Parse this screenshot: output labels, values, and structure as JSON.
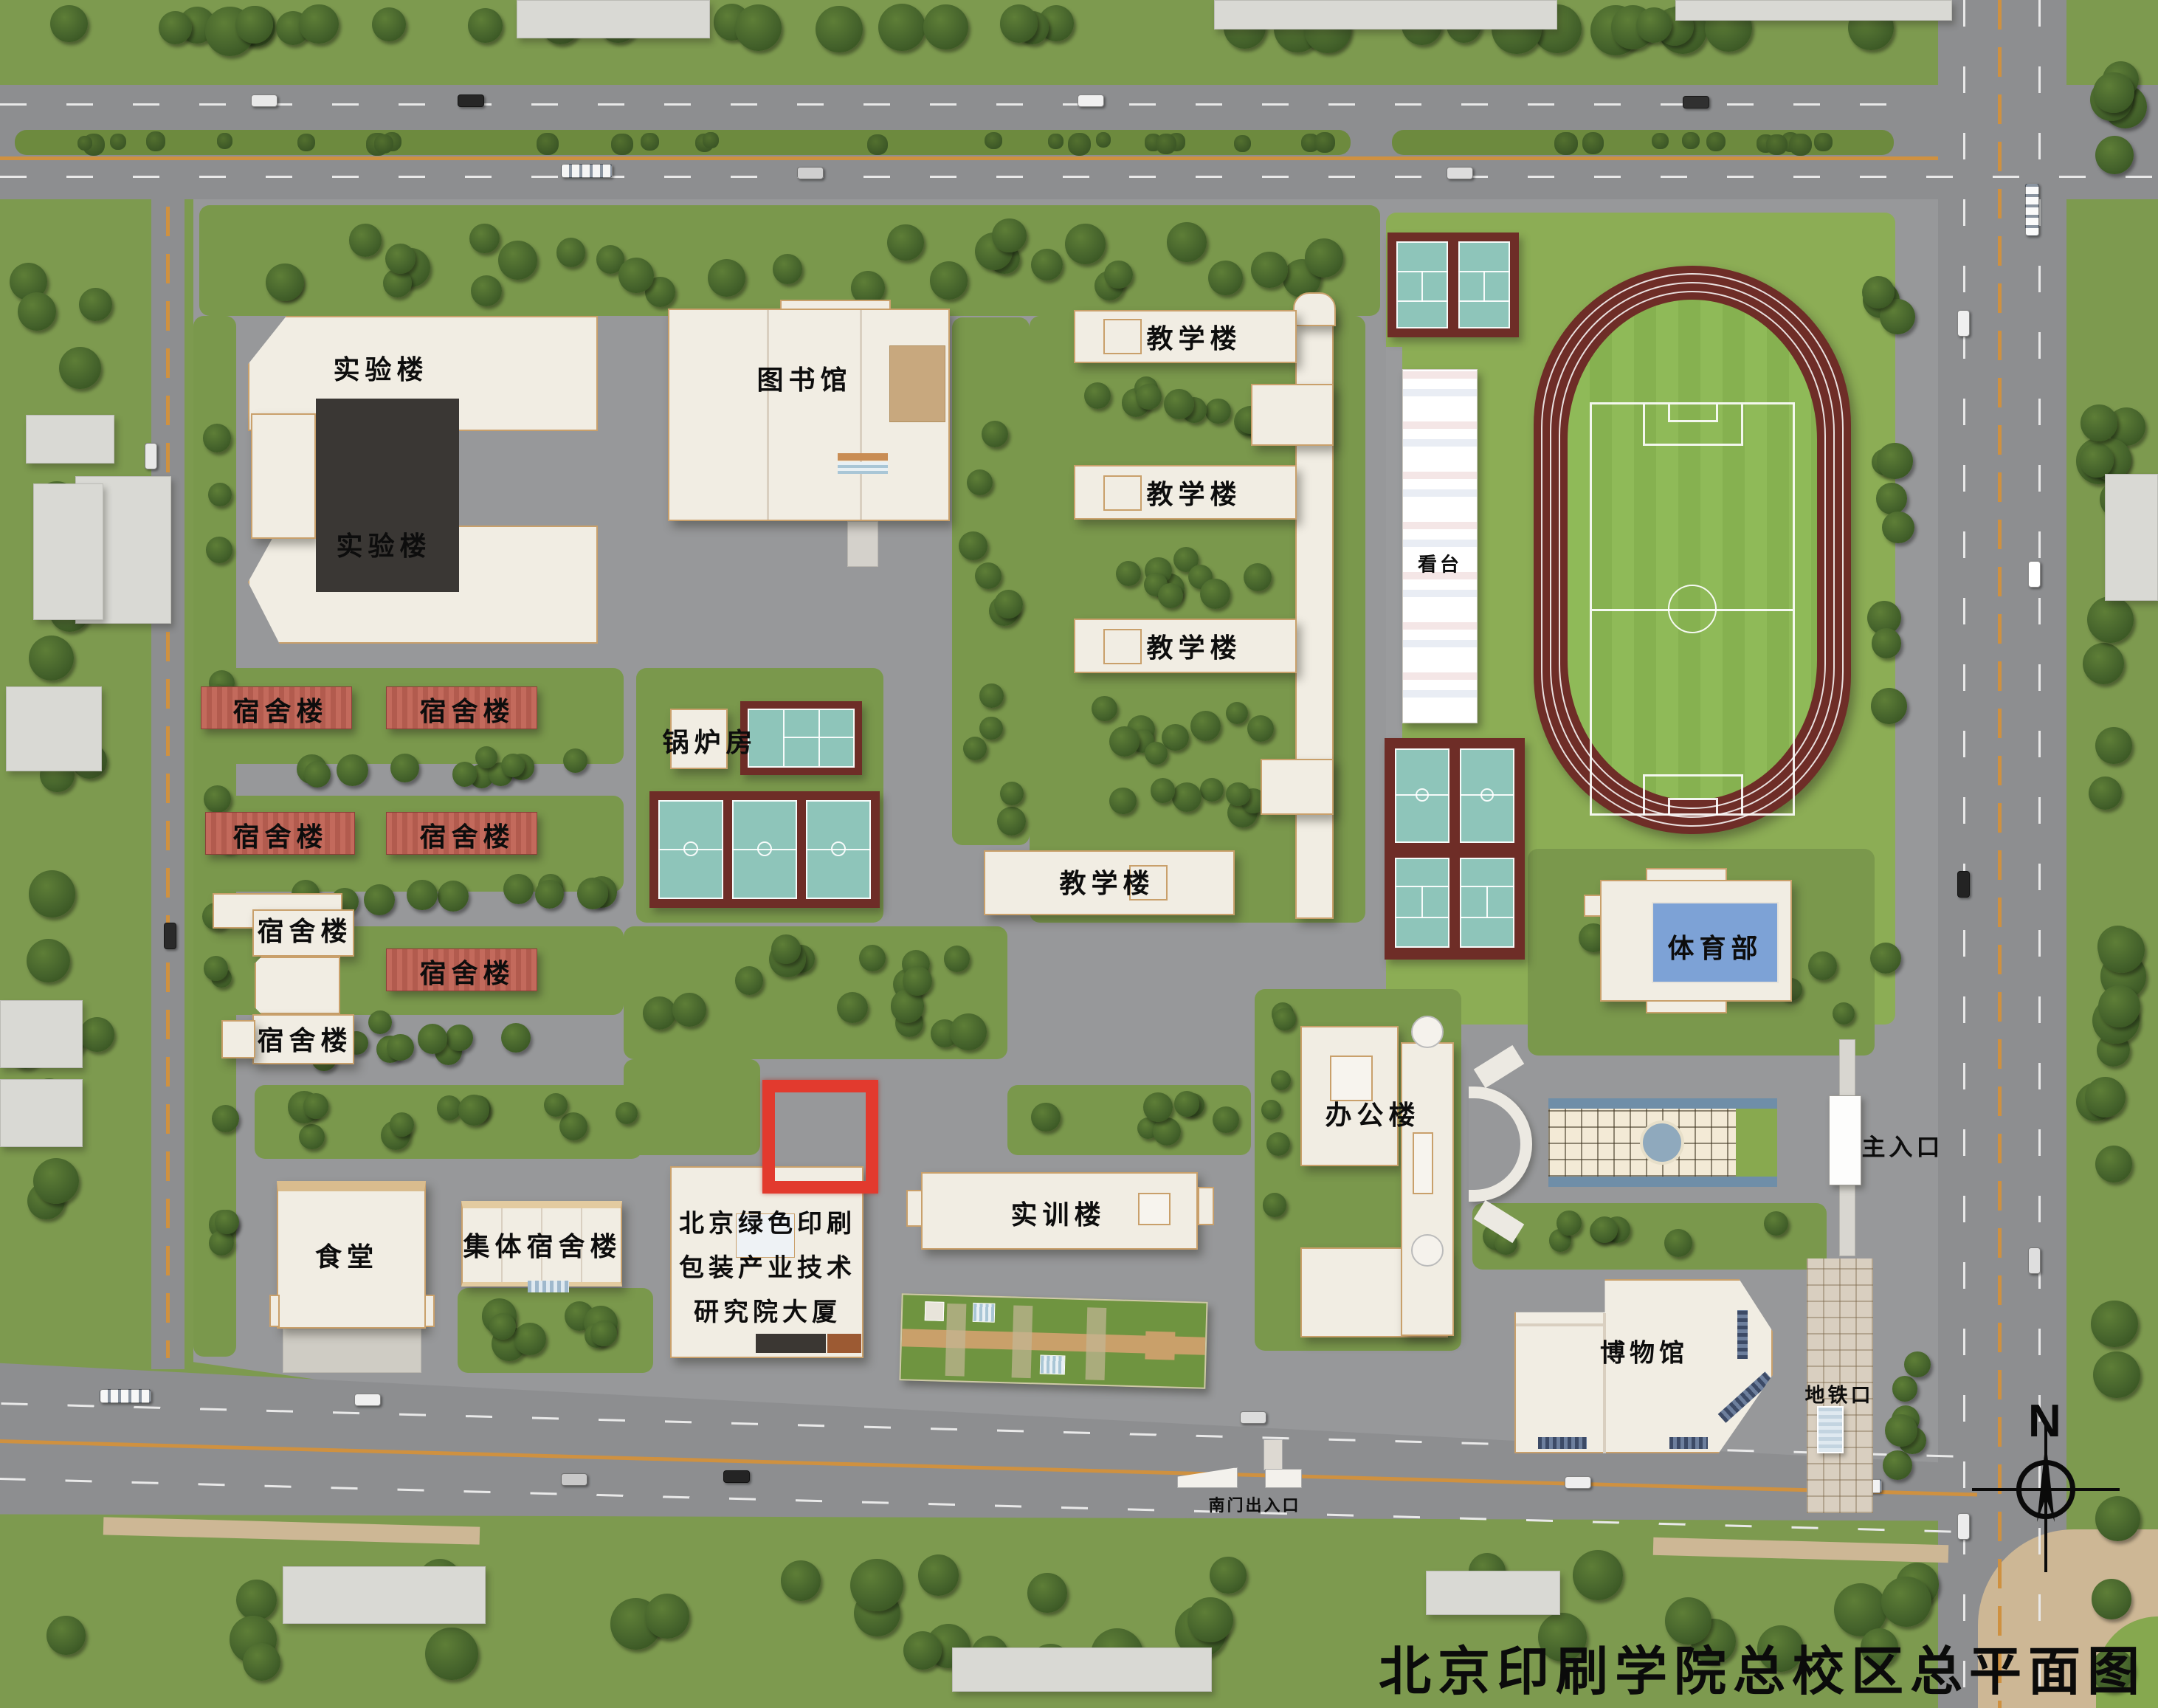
{
  "map": {
    "title": "北京印刷学院总校区总平面图",
    "compass_north": "N"
  },
  "buildings": {
    "laboratory_upper": "实验楼",
    "laboratory_lower": "实验楼",
    "library": "图书馆",
    "teaching_1": "教学楼",
    "teaching_2": "教学楼",
    "teaching_3": "教学楼",
    "teaching_4": "教学楼",
    "boiler_room": "锅炉房",
    "dormitories": [
      "宿舍楼",
      "宿舍楼",
      "宿舍楼",
      "宿舍楼",
      "宿舍楼",
      "宿舍楼",
      "宿舍楼"
    ],
    "collective_dormitory": "集体宿舍楼",
    "canteen": "食堂",
    "research_institute": {
      "line1": "北京绿色印刷",
      "line2": "包装产业技术",
      "line3": "研究院大厦"
    },
    "training_building": "实训楼",
    "office_building": "办公楼",
    "museum": "博物馆",
    "pe_department": "体育部",
    "grandstand": "看台"
  },
  "entrances": {
    "main_entrance": "主入口",
    "south_gate": "南门出入口",
    "subway_exit": "地铁口"
  },
  "colors": {
    "lawn": "#7a984c",
    "stadium_lawn": "#8cad55",
    "road": "#8d8e90",
    "building_white": "#f1ede3",
    "building_edge": "#c9a06b",
    "dorm_red": "#b85f52",
    "court_teal": "#8ec5ba",
    "court_frame_red": "#6e2d27",
    "track_red": "#6e2d27",
    "pe_roof_blue": "#7da2d6",
    "highlight_red": "#e23a2e",
    "center_line_orange": "#cf9140"
  }
}
